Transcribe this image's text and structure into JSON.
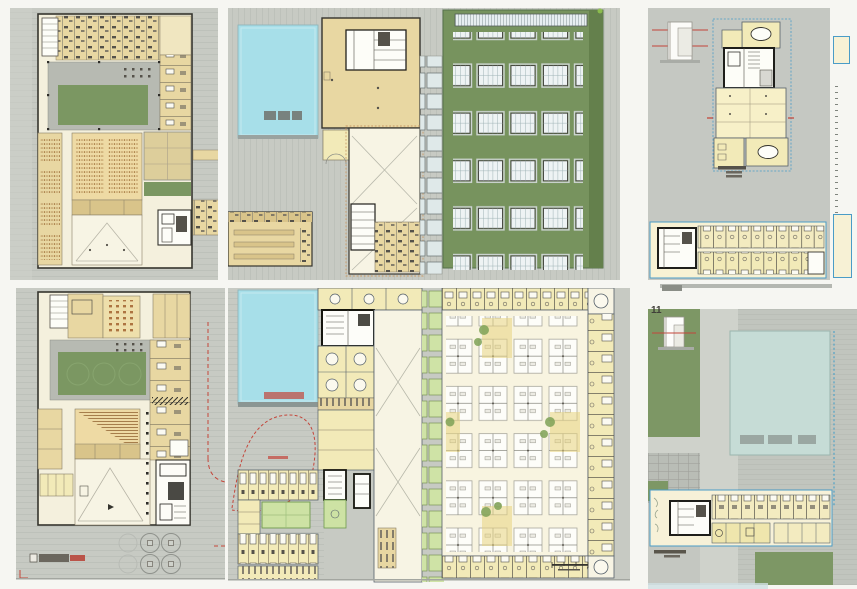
{
  "board": {
    "description": "Scanned architectural presentation board with six plan panels",
    "panels": {
      "top_left": {
        "kind": "upper floor plan",
        "features": [
          "courtyard",
          "auditorium",
          "classroom band",
          "service block"
        ]
      },
      "top_middle": {
        "kind": "roof plan",
        "features": [
          "swimming pool",
          "multipurpose hall",
          "green roof with skylight grid"
        ]
      },
      "top_right": {
        "kind": "tower floor plan with section detail",
        "caption_legible": false
      },
      "bottom_left": {
        "kind": "ground floor plan",
        "features": [
          "courtyard with trees",
          "raked auditorium",
          "lobby",
          "plaza trees"
        ],
        "caption_legible": false
      },
      "bottom_middle": {
        "kind": "ground floor plan",
        "features": [
          "swimming pool",
          "dormitory wing",
          "sports court",
          "open office hall",
          "compass"
        ],
        "caption_legible": false
      },
      "bottom_right": {
        "kind": "site plan",
        "label": "11",
        "features": [
          "lawns",
          "road",
          "reflecting pool",
          "linear building plan"
        ],
        "caption_legible": false
      }
    },
    "grids": {
      "roof_skylights": {
        "rows": 5,
        "cols": 4
      },
      "office_clusters": {
        "rows": 5,
        "cols": 4
      },
      "plaza_trees": 4,
      "courtyard_trees": 3
    },
    "palette": {
      "paper": "#f6f6f2",
      "sheet_gray": "#c7cac3",
      "sheet_stripe": "#bdc1ba",
      "court_paving": "#b7bab2",
      "building_cream": "#f4f0dd",
      "room_tan": "#e8d7a2",
      "room_tan_dark": "#d9c48a",
      "room_yellow": "#f2eab8",
      "wall_dark": "#35342e",
      "courtyard_green": "#7b9762",
      "roof_green": "#77935e",
      "roof_green_dark": "#64804c",
      "planter_green": "#cfe3a6",
      "pool_cyan": "#a7dfe9",
      "pool_pale": "#c6dcd6",
      "skylight_blue": "#e7eef0",
      "red_accent": "#c4453a",
      "blue_accent": "#4a9cc7",
      "office_cream": "#f8f4e0",
      "highlight_yellow": "#e8d47f",
      "plant_green": "#7fa257"
    }
  }
}
